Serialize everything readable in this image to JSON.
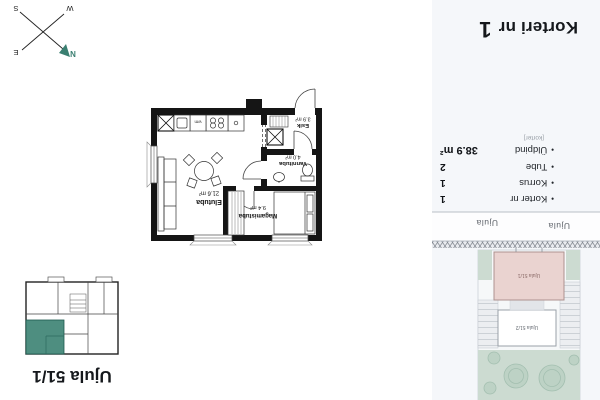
{
  "sheet": {
    "title_prefix": "Korteri nr",
    "title_number": "1"
  },
  "overview": {
    "title": "Ujula 51/1"
  },
  "info": {
    "bullet": "•",
    "rows": [
      {
        "label": "Korter nr",
        "value": "1"
      },
      {
        "label": "Korrus",
        "value": "1"
      },
      {
        "label": "Tube",
        "value": "2"
      },
      {
        "label": "Üldpind",
        "value": "38.9 m²"
      }
    ],
    "sublabel": "[korter]"
  },
  "floorplan": {
    "rooms": [
      {
        "name": "Elutuba",
        "area": "21.6 m²"
      },
      {
        "name": "Magamistuba",
        "area": "9.4 m²"
      },
      {
        "name": "Vannituba",
        "area": "4.0 m²"
      },
      {
        "name": "Esik",
        "area": "3.9 m²"
      }
    ],
    "washer_label": "wm"
  },
  "site": {
    "street": "Ujula",
    "building_main": "Ujula 51/1",
    "building_secondary": "Ujula 51/2"
  },
  "compass": {
    "n": "N",
    "e": "E",
    "s": "S",
    "w": "W"
  },
  "colors": {
    "accent_teal": "#4e8e80",
    "panel_bg": "#f5f7fa",
    "building_pink": "#ead3d0",
    "greenery": "#ccdbd1"
  }
}
